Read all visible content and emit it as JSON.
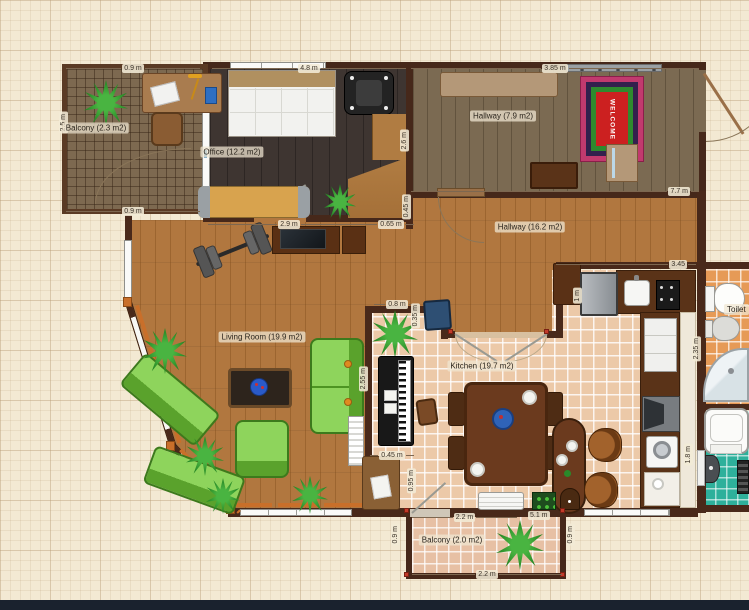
{
  "rooms": {
    "balcony_tl": {
      "label": "Balcony (2.3 m2)"
    },
    "office": {
      "label": "Office (12.2 m2)"
    },
    "hallway_small": {
      "label": "Hallway (7.9 m2)"
    },
    "hallway_large": {
      "label": "Hallway (16.2 m2)"
    },
    "living_room": {
      "label": "Living Room (19.9 m2)"
    },
    "kitchen": {
      "label": "Kitchen (19.7 m2)"
    },
    "balcony_bottom": {
      "label": "Balcony (2.0 m2)"
    },
    "toilet": {
      "label": "Toilet"
    }
  },
  "dimensions": {
    "top_balcony_width": "0.9 m",
    "office_top_width": "4.8 m",
    "hallway_top_width": "3.85 m",
    "balcony_left_height": "2.5 m",
    "balcony_bottom_width": "0.9 m",
    "office_bottom_width": "2.9 m",
    "office_bottom_small": "0.65 m",
    "office_right_height": "2.6 m",
    "office_right_small": "0.45 m",
    "hallway_bottom_width": "7.7 m",
    "kitchen_top_width": "3.45",
    "fridge_width": "1 m",
    "toilet_left_height": "2.35 m",
    "kitchen_nook_width": "0.8 m",
    "kitchen_nook_height": "0.35 m",
    "kitchen_left_height": "2.55 m",
    "kitchen_door_width": "0.45 m",
    "kitchen_door_height": "0.95 m",
    "kitchen_bottom_width": "5.1 m",
    "bathroom_right_height": "1.8 m",
    "balcony2_top_width": "2.2 m",
    "balcony2_bottom_width": "2.2 m",
    "balcony2_left_height": "0.9 m",
    "balcony2_right_height": "0.9 m"
  },
  "mat_text": "WELCOME",
  "colors": {
    "wall": "#49291a",
    "living_floor": "#b1773f",
    "office_floor": "#3e3531",
    "hallway_small_floor": "#7b6a52",
    "kitchen_tile": "#ecc9a8",
    "toilet_tile": "#e69a56",
    "bathroom_tile": "#2eb09b",
    "balcony_tile": "#7d6950",
    "sofa_green": "#7cc44c",
    "mat_red": "#cc2020",
    "curtain_orange": "#c96f2a"
  }
}
